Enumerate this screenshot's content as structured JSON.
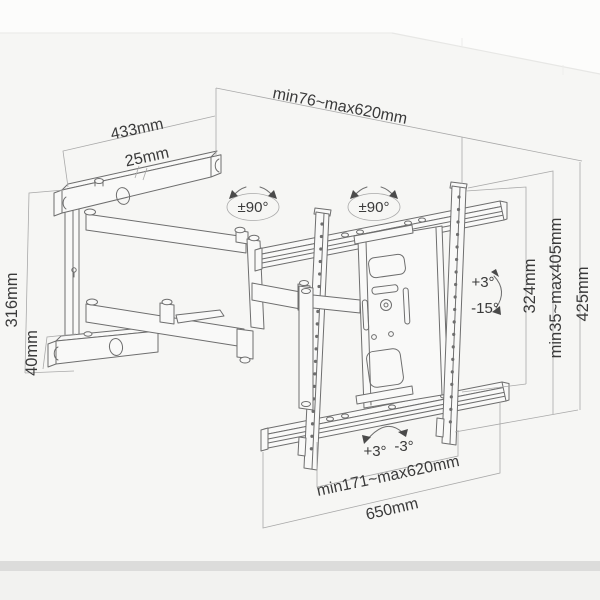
{
  "diagram": {
    "title": "Full-motion TV wall mount dimension drawing",
    "type": "product-dimension-diagram",
    "colors": {
      "backdrop": "#f6f6f4",
      "backdrop_top": "#fcfcfb",
      "floor_band": "#dcdcdb",
      "floor_below": "#f2f2f0",
      "drawing_line": "#6e6e6e",
      "dimension_line": "#a9a9a9",
      "label_text": "#3a3a3a"
    },
    "labels": {
      "arm_length": "433mm",
      "profile_width": "25mm",
      "extension_range": "min76~max620mm",
      "swivel_left": "±90°",
      "swivel_right": "±90°",
      "tilt_up": "+3°",
      "tilt_down": "-15°",
      "plate_height": "324mm",
      "height_range": "min35~max405mm",
      "total_height": "425mm",
      "wall_plate_height": "316mm",
      "arm_thickness": "40mm",
      "level_plus": "+3°",
      "level_minus": "-3°",
      "width_range": "min171~max620mm",
      "total_width": "650mm"
    }
  }
}
